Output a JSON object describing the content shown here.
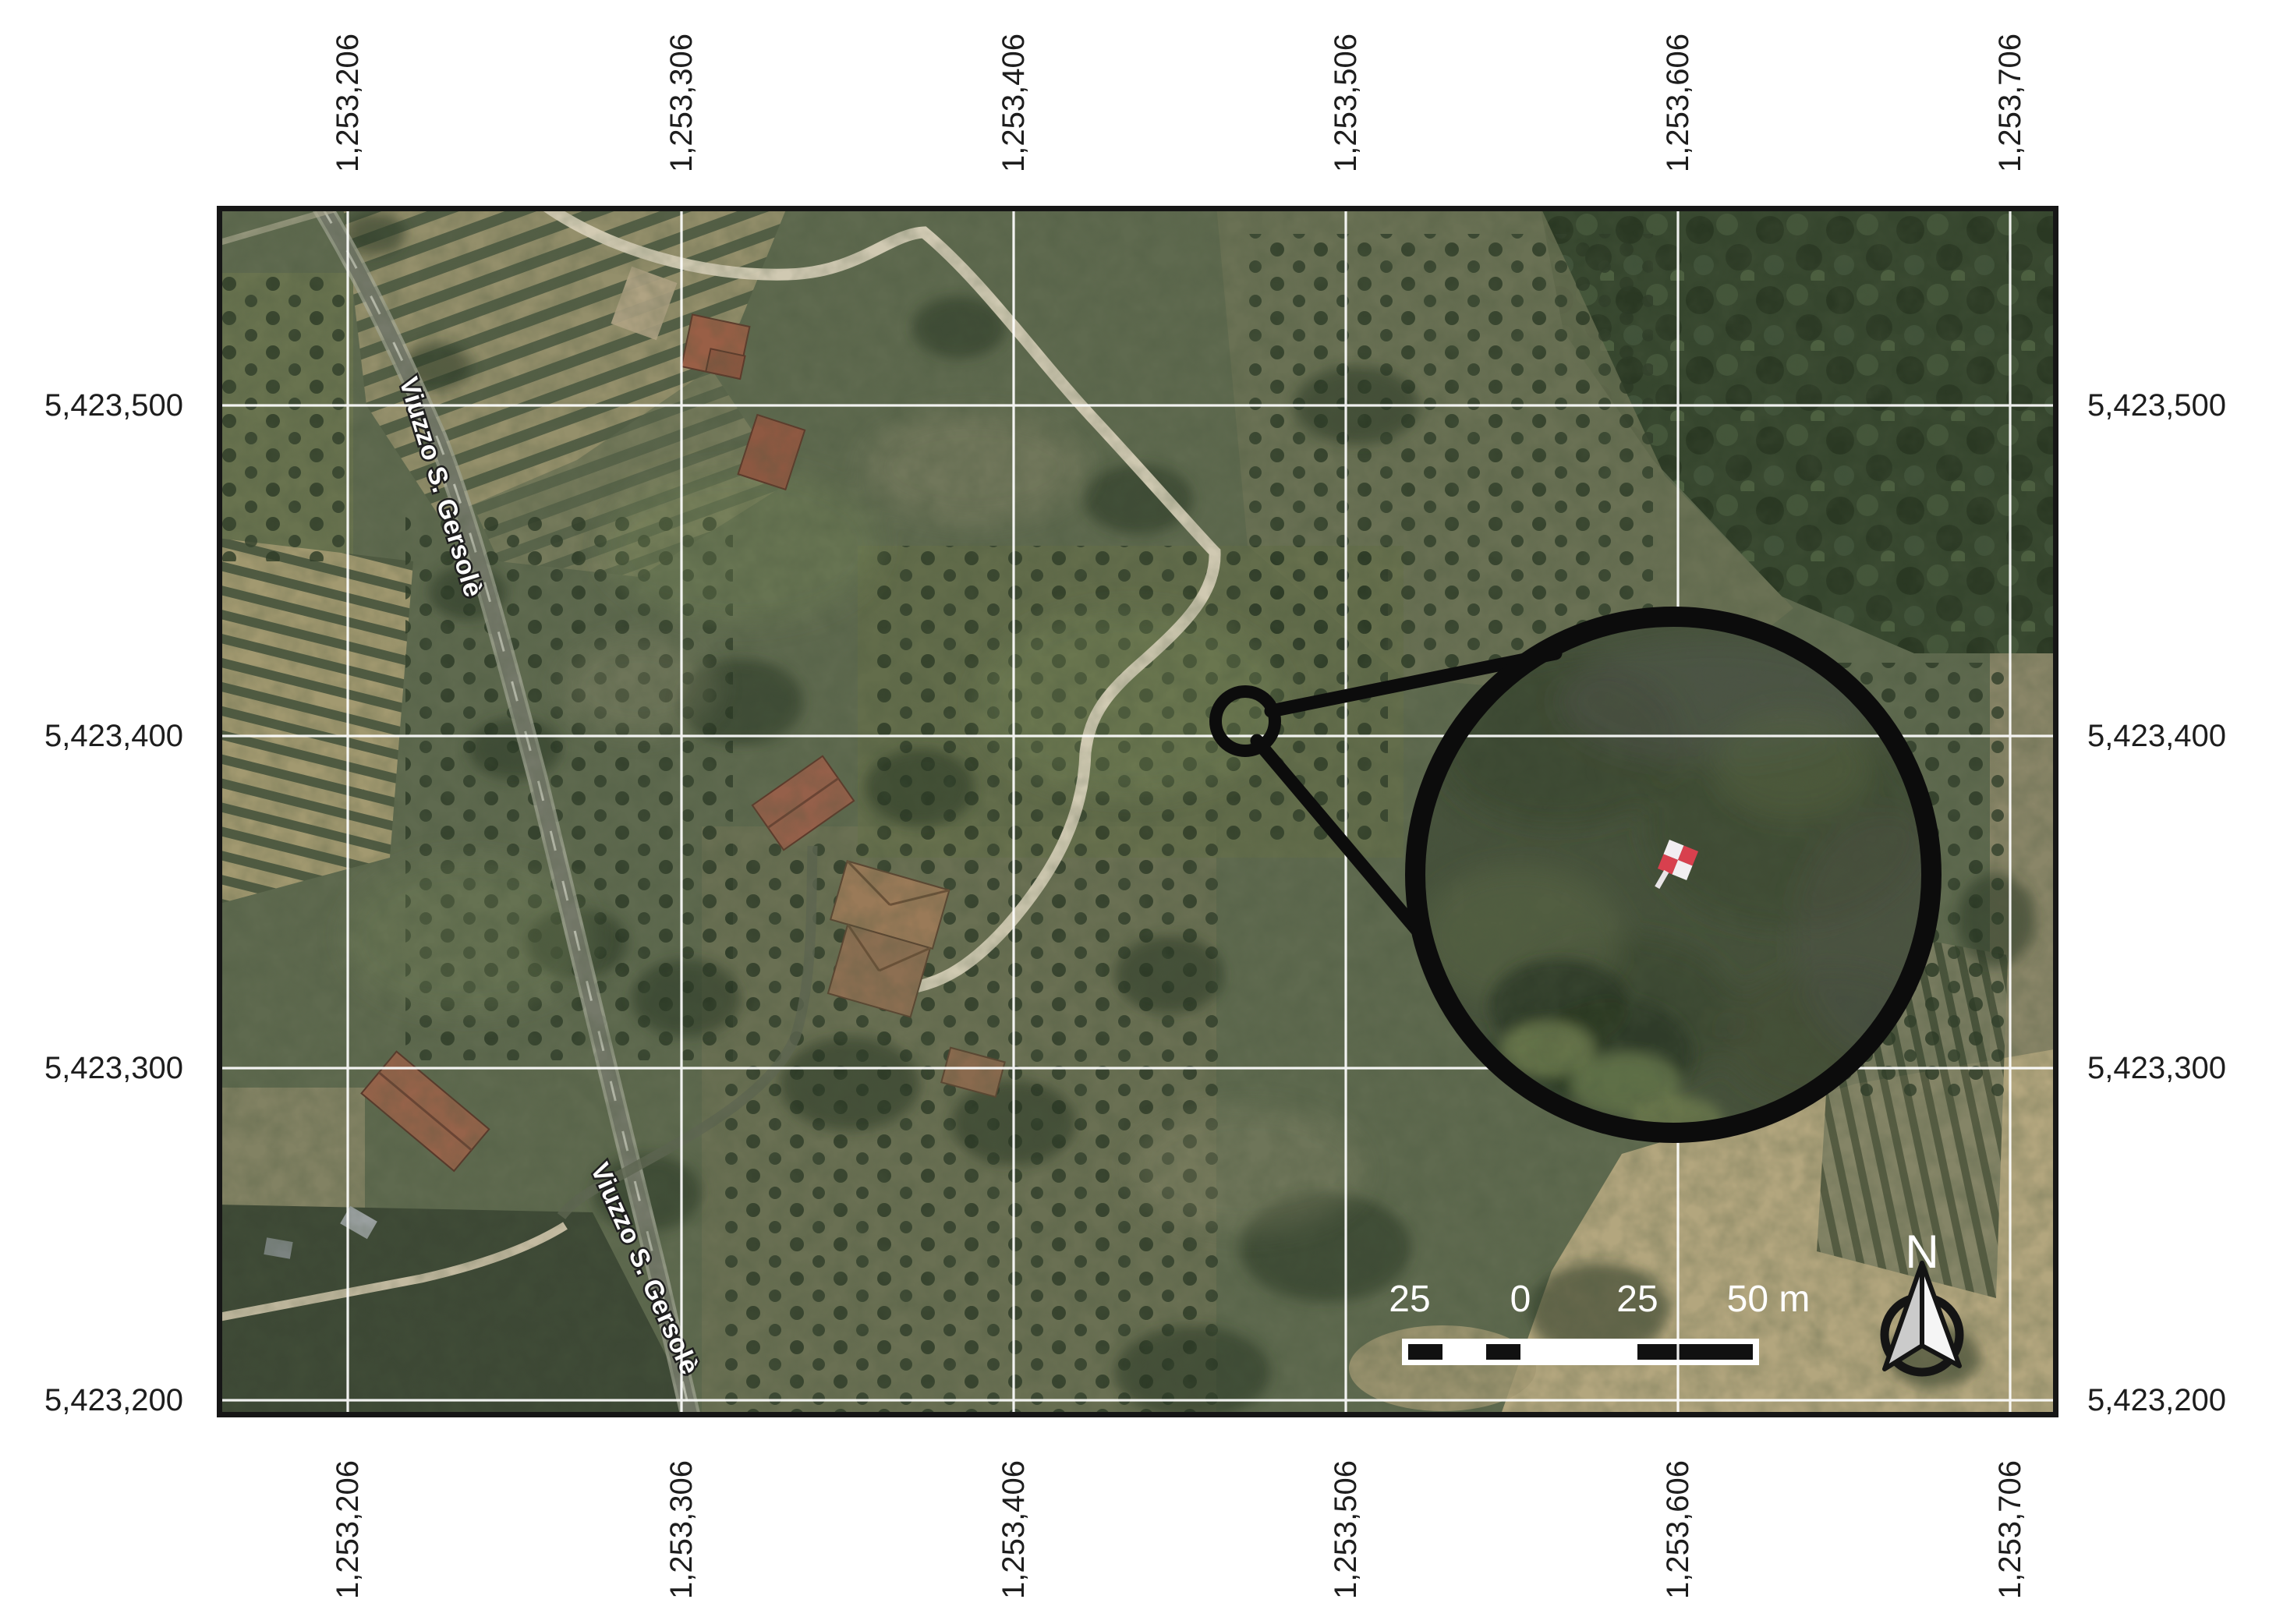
{
  "axes": {
    "top": [
      "1,253,206",
      "1,253,306",
      "1,253,406",
      "1,253,506",
      "1,253,606",
      "1,253,706"
    ],
    "bottom": [
      "1,253,206",
      "1,253,306",
      "1,253,406",
      "1,253,506",
      "1,253,606",
      "1,253,706"
    ],
    "left": [
      "5,423,500",
      "5,423,400",
      "5,423,300",
      "5,423,200"
    ],
    "right": [
      "5,423,500",
      "5,423,400",
      "5,423,300",
      "5,423,200"
    ]
  },
  "street_labels": [
    "Viuzzo S. Gersolè",
    "Viuzzo S. Gersolè"
  ],
  "scale_bar": {
    "labels": [
      "25",
      "0",
      "25",
      "50 m"
    ]
  },
  "north_arrow": {
    "label": "N"
  },
  "colors": {
    "gcp_red": "#d8404e",
    "gcp_white": "#f2eef1",
    "grid_line": "#ffffff",
    "frame": "#161616",
    "tick_text": "#1d1d1d",
    "scale_text": "#ffffff",
    "road": "#75796a",
    "driveway": "#d6cfb7"
  }
}
